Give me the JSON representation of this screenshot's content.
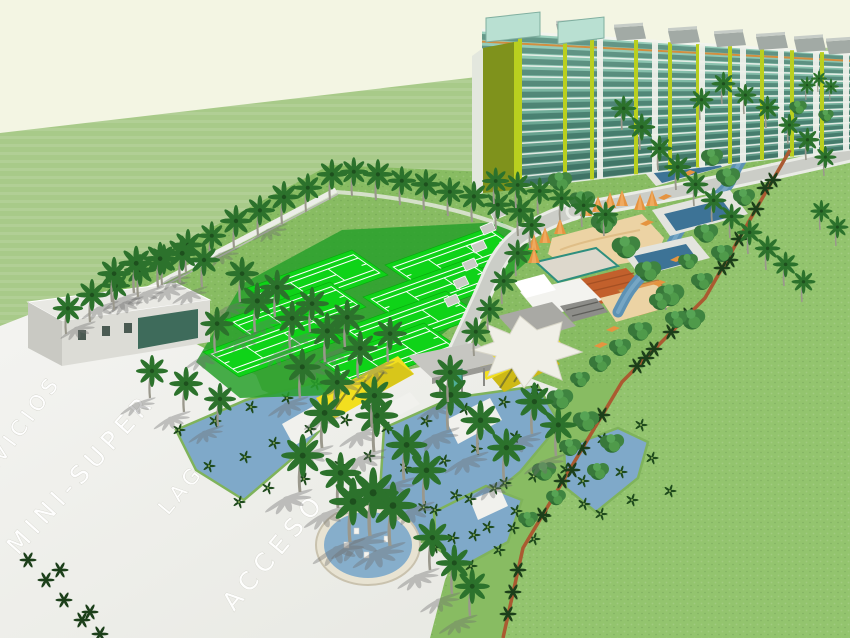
{
  "road_labels": {
    "servicios": "SERVICIOS",
    "mini_super": "MINI-SUPER",
    "lago": "LAGO",
    "acceso": "ACCESO"
  },
  "palette": {
    "sky": "#f3f5e3",
    "distant_grass": "#a8ca89",
    "lawn_grass": "#93c46e",
    "site_grass": "#88bc62",
    "pavement": "#f0f0ec",
    "road_gray": "#cbcdc7",
    "court_green": "#0fd318",
    "court_apron": "#28a02b",
    "water_bed": "#7fa9c9",
    "pool_deep": "#3d7396",
    "river": "#5d92b4",
    "towers_glass": "#7fbfae",
    "towers_glass_dark": "#33695d",
    "towers_lime": "#b9cf1f",
    "towers_olive": "#7f921c",
    "roof_gray": "#a2aaa5",
    "trim_orange": "#d28e3f",
    "clubhouse_roof": "#c2602c",
    "sand": "#ecd3a4",
    "umbrella_orange": "#e59440",
    "gate_yellow": "#f2df1f",
    "fence_red": "#aa5a31",
    "canopy_white": "#f0efe7",
    "palm_frond": "#2c722c",
    "palm_trunk": "#9a988c",
    "label_white": "#ffffff"
  }
}
